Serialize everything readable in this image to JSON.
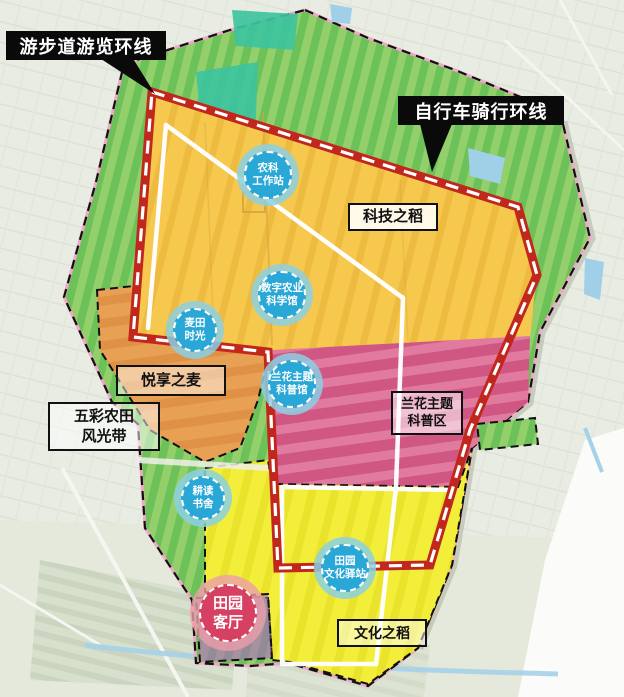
{
  "map": {
    "callouts": [
      {
        "id": "walking-loop",
        "label": "游步道游览环线"
      },
      {
        "id": "cycling-loop",
        "label": "自行车骑行环线"
      }
    ],
    "zone_labels": [
      {
        "id": "tech-rice",
        "label": "科技之稻"
      },
      {
        "id": "wheat-joy",
        "label": "悦享之麦"
      },
      {
        "id": "colorful-farm",
        "label": "五彩农田\n风光带"
      },
      {
        "id": "orchid-zone",
        "label": "兰花主题\n科普区"
      },
      {
        "id": "culture-rice",
        "label": "文化之稻"
      }
    ],
    "poi_badges": [
      {
        "id": "farm-science-station",
        "label": "农科\n工作站"
      },
      {
        "id": "digital-agri-museum",
        "label": "数字农业\n科学馆"
      },
      {
        "id": "wheat-field-time",
        "label": "麦田\n时光"
      },
      {
        "id": "orchid-museum",
        "label": "兰花主题\n科普馆"
      },
      {
        "id": "reading-house",
        "label": "耕读\n书舍"
      },
      {
        "id": "pastoral-post",
        "label": "田园\n文化驿站"
      }
    ],
    "highlight_badge": {
      "id": "pastoral-living-room",
      "label": "田园\n客厅"
    },
    "colors": {
      "route_red": "#c1271d",
      "route_dash_white": "#ffffff",
      "walk_path_white": "#ffffff",
      "badge_blue": "#29a7d6",
      "badge_ring_blue": "#8bd0e4",
      "highlight_pink": "#d64062",
      "highlight_ring": "#eb9eaa",
      "zone_tech_rice_yellow": "#f6c94e",
      "zone_wheat_orange": "#e8a055",
      "zone_orchid_pink": "#d9648f",
      "zone_culture_yellow": "#f3ee3a",
      "zone_living_purple": "#b55fc9",
      "field_green": "#6cc258",
      "field_green_light": "#93d06b",
      "teal_patch": "#3dc39e",
      "boundary_pink_line": "#f0a8c8",
      "callout_black": "#0a0a0a"
    }
  }
}
